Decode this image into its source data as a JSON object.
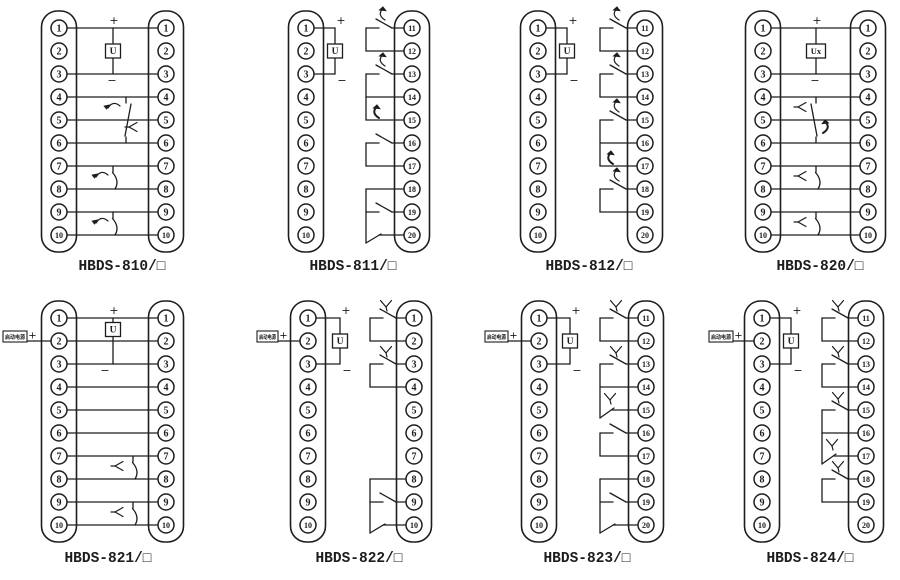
{
  "canvas": {
    "width": 900,
    "height": 580,
    "background": "#ffffff",
    "line_color": "#1d1d1d"
  },
  "row_geometry": {
    "top_first_row_y": 28,
    "bottom_first_row_y": 318,
    "row_spacing": 23
  },
  "diagrams": [
    {
      "model_label": "HBDS-810/□",
      "left_terminals": [
        "1",
        "2",
        "3",
        "4",
        "5",
        "6",
        "7",
        "8",
        "9",
        "10"
      ],
      "right_terminals": [
        "1",
        "2",
        "3",
        "4",
        "5",
        "6",
        "7",
        "8",
        "9",
        "10"
      ],
      "coil": {
        "style": "center",
        "text": "U",
        "plus": "+",
        "minus": "−",
        "x": 113,
        "top_row": 1,
        "bottom_row": 3
      },
      "through_rows": [
        1,
        3,
        4,
        5,
        6,
        7,
        8,
        9,
        10
      ],
      "center_groups": [
        {
          "type": "changeover",
          "rows": [
            4,
            5,
            6
          ],
          "x": 126,
          "variant": "arrow"
        },
        {
          "type": "no",
          "rows": [
            7,
            8
          ],
          "x": 113,
          "variant": "arrow"
        },
        {
          "type": "no",
          "rows": [
            9,
            10
          ],
          "x": 113,
          "variant": "arrow"
        }
      ],
      "layout": {
        "band": 0,
        "lx": 59,
        "rx": 166,
        "label_cx": 122
      }
    },
    {
      "model_label": "HBDS-811/□",
      "left_terminals": [
        "1",
        "2",
        "3",
        "4",
        "5",
        "6",
        "7",
        "8",
        "9",
        "10"
      ],
      "right_terminals": [
        "11",
        "12",
        "13",
        "14",
        "15",
        "16",
        "17",
        "18",
        "19",
        "20"
      ],
      "coil": {
        "style": "side",
        "text": "U",
        "plus": "+",
        "minus": "−",
        "x": 335,
        "top_row": 1,
        "bottom_row": 3
      },
      "bracket_groups": [
        {
          "rows": [
            11,
            12
          ],
          "contact_row": 11,
          "glyph": "arrow"
        },
        {
          "rows": [
            13,
            14,
            15
          ],
          "contact_row": 13,
          "glyph": "arrow",
          "end": "bold-arrow"
        },
        {
          "rows": [
            16,
            17
          ],
          "contact_row": 16,
          "glyph": null
        },
        {
          "rows": [
            18,
            19,
            20
          ],
          "contact_row": 19,
          "glyph": null,
          "end": "corner-blade"
        }
      ],
      "layout": {
        "band": 0,
        "lx": 306,
        "rx": 412,
        "label_cx": 353,
        "bx": 366
      }
    },
    {
      "model_label": "HBDS-812/□",
      "left_terminals": [
        "1",
        "2",
        "3",
        "4",
        "5",
        "6",
        "7",
        "8",
        "9",
        "10"
      ],
      "right_terminals": [
        "11",
        "12",
        "13",
        "14",
        "15",
        "16",
        "17",
        "18",
        "19",
        "20"
      ],
      "coil": {
        "style": "side",
        "text": "U",
        "plus": "+",
        "minus": "−",
        "x": 567,
        "top_row": 1,
        "bottom_row": 3
      },
      "bracket_groups": [
        {
          "rows": [
            11,
            12
          ],
          "contact_row": 11,
          "glyph": "arrow"
        },
        {
          "rows": [
            13,
            14
          ],
          "contact_row": 13,
          "glyph": "arrow"
        },
        {
          "rows": [
            15,
            16,
            17
          ],
          "contact_row": 15,
          "glyph": "arrow",
          "end": "bold-arrow"
        },
        {
          "rows": [
            18,
            19
          ],
          "contact_row": 18,
          "glyph": "arrow"
        }
      ],
      "layout": {
        "band": 0,
        "lx": 538,
        "rx": 645,
        "label_cx": 589,
        "bx": 600
      }
    },
    {
      "model_label": "HBDS-820/□",
      "left_terminals": [
        "1",
        "2",
        "3",
        "4",
        "5",
        "6",
        "7",
        "8",
        "9",
        "10"
      ],
      "right_terminals": [
        "1",
        "2",
        "3",
        "4",
        "5",
        "6",
        "7",
        "8",
        "9",
        "10"
      ],
      "coil": {
        "style": "center",
        "text": "Ux",
        "plus": "+",
        "minus": "−",
        "x": 816,
        "top_row": 1,
        "bottom_row": 3
      },
      "through_rows": [
        1,
        3,
        4,
        5,
        6,
        7,
        8,
        9,
        10
      ],
      "center_groups": [
        {
          "type": "changeover",
          "rows": [
            4,
            5,
            6
          ],
          "x": 816,
          "variant": "fork"
        },
        {
          "type": "no",
          "rows": [
            7,
            8
          ],
          "x": 816,
          "variant": "fork"
        },
        {
          "type": "no",
          "rows": [
            9,
            10
          ],
          "x": 816,
          "variant": "fork"
        }
      ],
      "layout": {
        "band": 0,
        "lx": 763,
        "rx": 868,
        "label_cx": 820
      }
    },
    {
      "model_label": "HBDS-821/□",
      "left_terminals": [
        "1",
        "2",
        "3",
        "4",
        "5",
        "6",
        "7",
        "8",
        "9",
        "10"
      ],
      "right_terminals": [
        "1",
        "2",
        "3",
        "4",
        "5",
        "6",
        "7",
        "8",
        "9",
        "10"
      ],
      "coil": {
        "style": "center-high",
        "text": "U",
        "plus": "+",
        "minus": "−",
        "x": 113,
        "top_row": 1,
        "bottom_row": 3
      },
      "feed": {
        "label": "启动电源",
        "plus": "+",
        "x": 3,
        "w": 24,
        "row": 2
      },
      "through_rows": [
        1,
        2,
        3,
        4,
        5,
        6,
        7,
        8,
        9,
        10
      ],
      "center_groups": [
        {
          "type": "no",
          "rows": [
            7,
            8
          ],
          "x": 133,
          "variant": "fork"
        },
        {
          "type": "no",
          "rows": [
            9,
            10
          ],
          "x": 133,
          "variant": "fork"
        }
      ],
      "layout": {
        "band": 1,
        "lx": 59,
        "rx": 166,
        "label_cx": 108
      }
    },
    {
      "model_label": "HBDS-822/□",
      "left_terminals": [
        "1",
        "2",
        "3",
        "4",
        "5",
        "6",
        "7",
        "8",
        "9",
        "10"
      ],
      "right_terminals": [
        "1",
        "2",
        "3",
        "4",
        "5",
        "6",
        "7",
        "8",
        "9",
        "10"
      ],
      "coil": {
        "style": "side",
        "text": "U",
        "plus": "+",
        "minus": "−",
        "x": 340,
        "top_row": 1,
        "bottom_row": 3
      },
      "feed": {
        "label": "启动电源",
        "plus": "+",
        "x": 257,
        "w": 21,
        "row": 2
      },
      "bracket_groups": [
        {
          "rows": [
            1,
            2
          ],
          "contact_row": 1,
          "glyph": "fork"
        },
        {
          "rows": [
            3,
            4
          ],
          "contact_row": 3,
          "glyph": "fork"
        },
        {
          "rows": [
            8,
            9,
            10
          ],
          "contact_row": 9,
          "glyph": null,
          "end": "corner-blade"
        }
      ],
      "layout": {
        "band": 1,
        "lx": 308,
        "rx": 414,
        "label_cx": 359,
        "bx": 370
      }
    },
    {
      "model_label": "HBDS-823/□",
      "left_terminals": [
        "1",
        "2",
        "3",
        "4",
        "5",
        "6",
        "7",
        "8",
        "9",
        "10"
      ],
      "right_terminals": [
        "11",
        "12",
        "13",
        "14",
        "15",
        "16",
        "17",
        "18",
        "19",
        "20"
      ],
      "coil": {
        "style": "side",
        "text": "U",
        "plus": "+",
        "minus": "−",
        "x": 570,
        "top_row": 1,
        "bottom_row": 3
      },
      "feed": {
        "label": "启动电源",
        "plus": "+",
        "x": 485,
        "w": 23,
        "row": 2
      },
      "bracket_groups": [
        {
          "rows": [
            11,
            12
          ],
          "contact_row": 11,
          "glyph": "fork"
        },
        {
          "rows": [
            13,
            14,
            15
          ],
          "contact_row": 13,
          "glyph": "fork",
          "end": "contact-fork"
        },
        {
          "rows": [
            16,
            17
          ],
          "contact_row": 16,
          "glyph": null
        },
        {
          "rows": [
            18,
            19,
            20
          ],
          "contact_row": 19,
          "glyph": null,
          "end": "corner-blade"
        }
      ],
      "layout": {
        "band": 1,
        "lx": 539,
        "rx": 646,
        "label_cx": 587,
        "bx": 600
      }
    },
    {
      "model_label": "HBDS-824/□",
      "left_terminals": [
        "1",
        "2",
        "3",
        "4",
        "5",
        "6",
        "7",
        "8",
        "9",
        "10"
      ],
      "right_terminals": [
        "11",
        "12",
        "13",
        "14",
        "15",
        "16",
        "17",
        "18",
        "19",
        "20"
      ],
      "coil": {
        "style": "side",
        "text": "U",
        "plus": "+",
        "minus": "−",
        "x": 791,
        "top_row": 1,
        "bottom_row": 3
      },
      "feed": {
        "label": "启动电源",
        "plus": "+",
        "x": 709,
        "w": 24,
        "row": 2
      },
      "bracket_groups": [
        {
          "rows": [
            11,
            12
          ],
          "contact_row": 11,
          "glyph": "fork"
        },
        {
          "rows": [
            13,
            14
          ],
          "contact_row": 13,
          "glyph": "fork"
        },
        {
          "rows": [
            15,
            16,
            17
          ],
          "contact_row": 15,
          "glyph": "fork",
          "end": "contact-fork"
        },
        {
          "rows": [
            18,
            19
          ],
          "contact_row": 18,
          "glyph": "fork"
        }
      ],
      "layout": {
        "band": 1,
        "lx": 762,
        "rx": 866,
        "label_cx": 810,
        "bx": 822
      }
    }
  ]
}
